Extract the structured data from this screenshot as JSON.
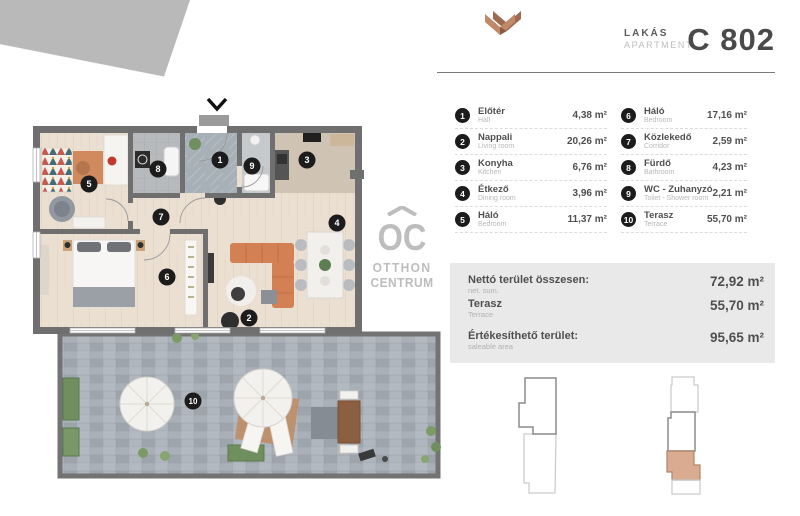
{
  "header": {
    "type_hu": "LAKÁS",
    "type_en": "APARTMENT",
    "unit_number": "C 802"
  },
  "rooms": [
    {
      "num": "1",
      "name_hu": "Előtér",
      "name_en": "Hall",
      "area": "4,38 m²"
    },
    {
      "num": "2",
      "name_hu": "Nappali",
      "name_en": "Living room",
      "area": "20,26 m²"
    },
    {
      "num": "3",
      "name_hu": "Konyha",
      "name_en": "Kitchen",
      "area": "6,76 m²"
    },
    {
      "num": "4",
      "name_hu": "Étkező",
      "name_en": "Dining room",
      "area": "3,96 m²"
    },
    {
      "num": "5",
      "name_hu": "Háló",
      "name_en": "Bedroom",
      "area": "11,37 m²"
    },
    {
      "num": "6",
      "name_hu": "Háló",
      "name_en": "Bedroom",
      "area": "17,16 m²"
    },
    {
      "num": "7",
      "name_hu": "Közlekedő",
      "name_en": "Corridor",
      "area": "2,59 m²"
    },
    {
      "num": "8",
      "name_hu": "Fürdő",
      "name_en": "Bathroom",
      "area": "4,23 m²"
    },
    {
      "num": "9",
      "name_hu": "WC - Zuhanyzó",
      "name_en": "Toilet - Shower room",
      "area": "2,21 m²"
    },
    {
      "num": "10",
      "name_hu": "Terasz",
      "name_en": "Terrace",
      "area": "55,70 m²"
    }
  ],
  "summary": [
    {
      "label_hu": "Nettó terület összesen:",
      "label_en": "net. sum.",
      "value": "72,92 m²"
    },
    {
      "label_hu": "Terasz",
      "label_en": "Terrace",
      "value": "55,70 m²"
    },
    {
      "label_hu": "Értékesíthető terület:",
      "label_en": "saleable area",
      "value": "95,65 m²"
    }
  ],
  "watermark": {
    "logo": "OC",
    "line1": "OTTHON",
    "line2": "CENTRUM"
  },
  "colors": {
    "brand_copper": "#b57c61",
    "text_dark": "#4a4a4a",
    "text_light": "#b8b8b8",
    "summary_bg": "#e9e9e9",
    "badge_black": "#1c1c1c",
    "unit_highlight": "#d9ac92",
    "wall_gray": "#6f6f6f"
  }
}
